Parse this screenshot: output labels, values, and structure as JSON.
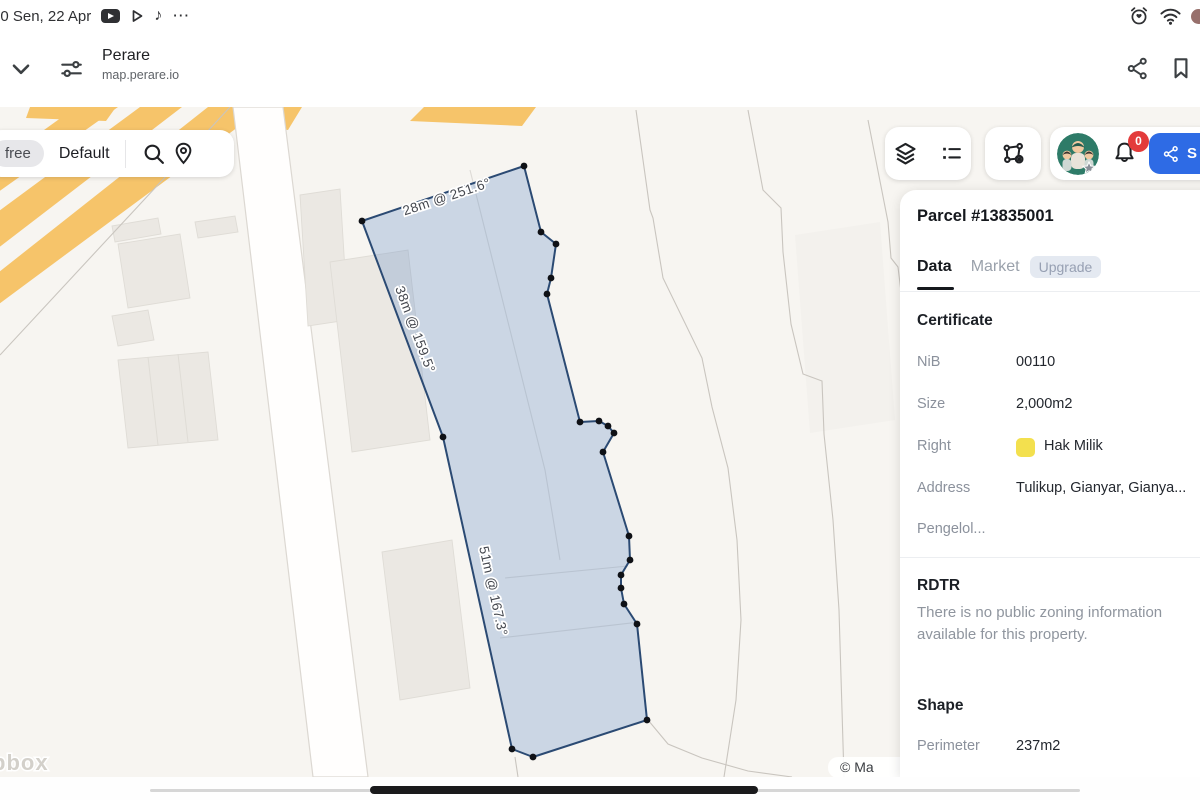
{
  "status_bar": {
    "datetime": "00 Sen, 22 Apr",
    "left_icons": [
      "youtube-icon",
      "play-icon",
      "tiktok-icon",
      "more-icon"
    ],
    "right_icons": [
      "alarm-icon",
      "wifi-icon",
      "battery-icon"
    ]
  },
  "browser": {
    "site_name": "Perare",
    "site_url": "map.perare.io"
  },
  "map_controls": {
    "plan_badge": "free",
    "style_label": "Default"
  },
  "account": {
    "notification_count": "0",
    "share_button_label": "S"
  },
  "map": {
    "edge_labels": [
      {
        "text": "28m @ 251.6°"
      },
      {
        "text": "38m @ 159.5°"
      },
      {
        "text": "51m @ 167.3°"
      }
    ],
    "attribution": "© Ma",
    "logo_partial": "pbox"
  },
  "panel": {
    "title": "Parcel #13835001",
    "tabs": {
      "data": "Data",
      "market": "Market",
      "upgrade_badge": "Upgrade"
    },
    "certificate": {
      "heading": "Certificate",
      "rows": [
        {
          "label": "NiB",
          "value": "00110"
        },
        {
          "label": "Size",
          "value": "2,000m2"
        },
        {
          "label": "Right",
          "value": "Hak Milik"
        },
        {
          "label": "Address",
          "value": "Tulikup, Gianyar, Gianya..."
        },
        {
          "label": "Pengelol...",
          "value": ""
        }
      ]
    },
    "rdtr": {
      "heading": "RDTR",
      "empty_text": "There is no public zoning information available for this property."
    },
    "shape": {
      "heading": "Shape",
      "rows": [
        {
          "label": "Perimeter",
          "value": "237m2"
        }
      ]
    }
  },
  "colors": {
    "accent_blue": "#2e6be5",
    "parcel_fill": "#9db9dd",
    "parcel_stroke": "#2b4a73",
    "right_yellow": "#f3e04e",
    "badge_red": "#e33b3b",
    "road_orange": "#f6c46a"
  }
}
